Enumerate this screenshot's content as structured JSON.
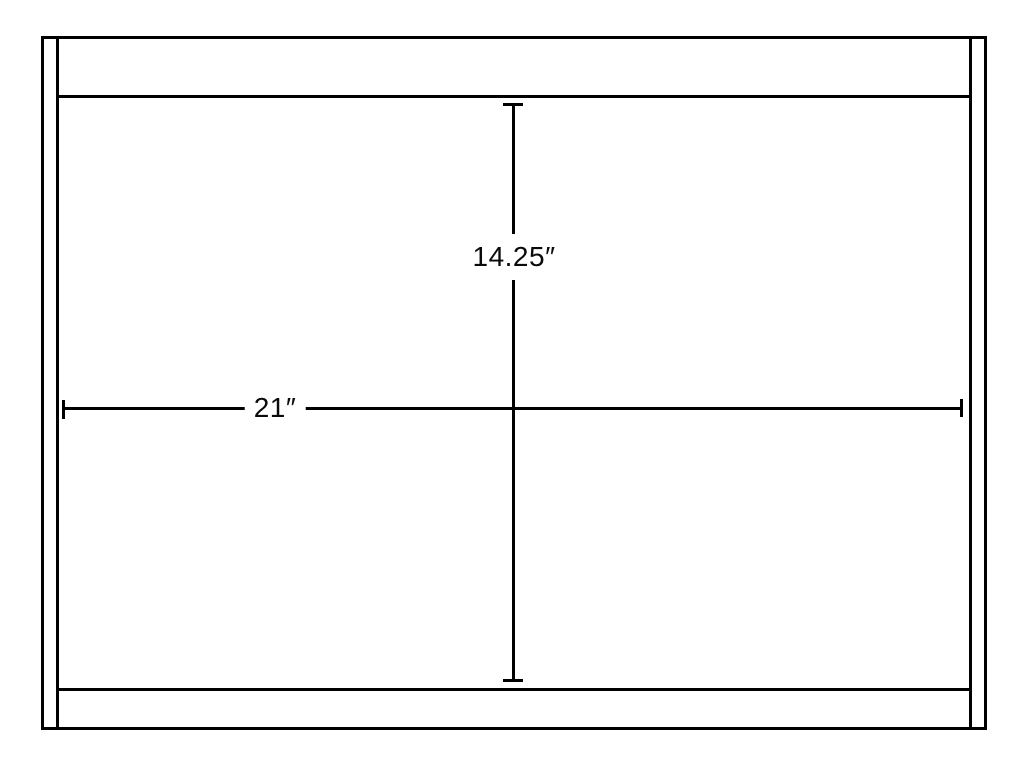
{
  "diagram": {
    "description": "Front-view technical line drawing of a rectangular cabinet with left and right side panels, a top rail and a bottom rail, annotated with two dimension lines",
    "background_color": "#ffffff",
    "line_color": "#000000",
    "dimensions": {
      "height_label": "14.25″",
      "width_label": "21″"
    }
  }
}
